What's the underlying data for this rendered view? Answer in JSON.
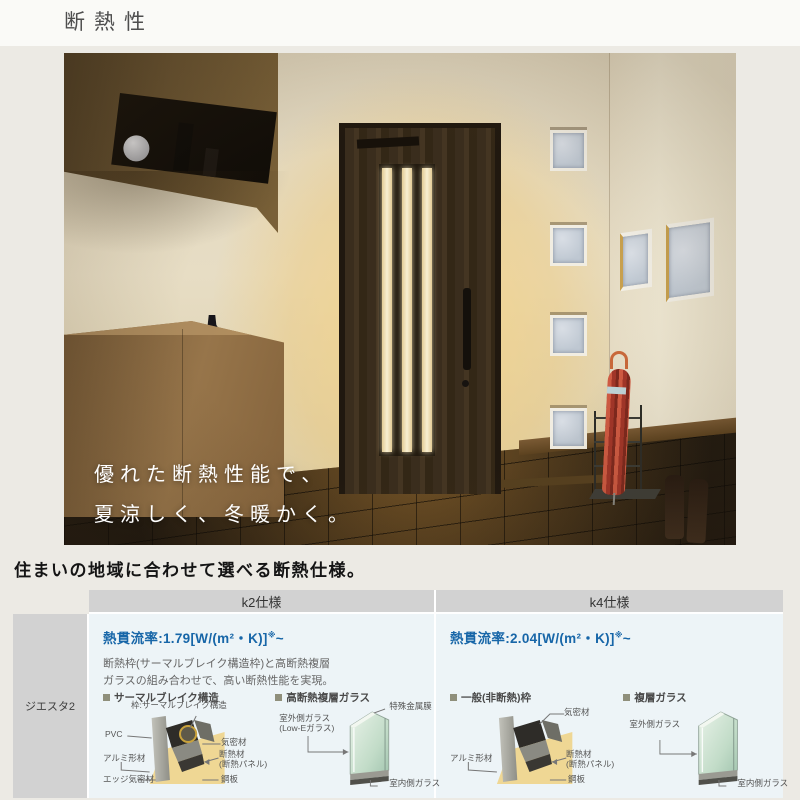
{
  "page": {
    "title": "断熱性"
  },
  "hero": {
    "caption_line1": "優れた断熱性能で、",
    "caption_line2": "夏涼しく、冬暖かく。"
  },
  "section": {
    "heading": "住まいの地域に合わせて選べる断熱仕様。"
  },
  "colors": {
    "accent_blue": "#1766A8",
    "header_gray": "#D2D2D2",
    "cell_bg": "#EDF4F7",
    "insulation_yellow": "#EFD794"
  },
  "table": {
    "row_label": "ジエスタ2",
    "k2": {
      "header": "k2仕様",
      "u_label": "熱貫流率:",
      "u_value": "1.79",
      "u_unit": "[W/(m²・K)]",
      "u_sup": "※",
      "u_tilde": "~",
      "desc1": "断熱枠(サーマルブレイク構造枠)と高断熱複層",
      "desc2": "ガラスの組み合わせで、高い断熱性能を実現。",
      "frame": {
        "title": "サーマルブレイク構造",
        "label_top": "枠:サーマルブレイク構造",
        "label_pvc": "PVC",
        "label_airtight": "気密材",
        "label_alumi": "アルミ形材",
        "label_insul1": "断熱材",
        "label_insul2": "(断熱パネル)",
        "label_edge": "エッジ気密材",
        "label_steel": "鋼板"
      },
      "glass": {
        "title": "高断熱複層ガラス",
        "label_film": "特殊金属膜",
        "label_outer": "室外側ガラス",
        "label_outer2": "(Low-Eガラス)",
        "label_inner": "室内側ガラス"
      }
    },
    "k4": {
      "header": "k4仕様",
      "u_label": "熱貫流率:",
      "u_value": "2.04",
      "u_unit": "[W/(m²・K)]",
      "u_sup": "※",
      "u_tilde": "~",
      "frame": {
        "title": "一般(非断熱)枠",
        "label_airtight": "気密材",
        "label_alumi": "アルミ形材",
        "label_insul1": "断熱材",
        "label_insul2": "(断熱パネル)",
        "label_steel": "鋼板"
      },
      "glass": {
        "title": "複層ガラス",
        "label_outer": "室外側ガラス",
        "label_inner": "室内側ガラス"
      }
    }
  }
}
